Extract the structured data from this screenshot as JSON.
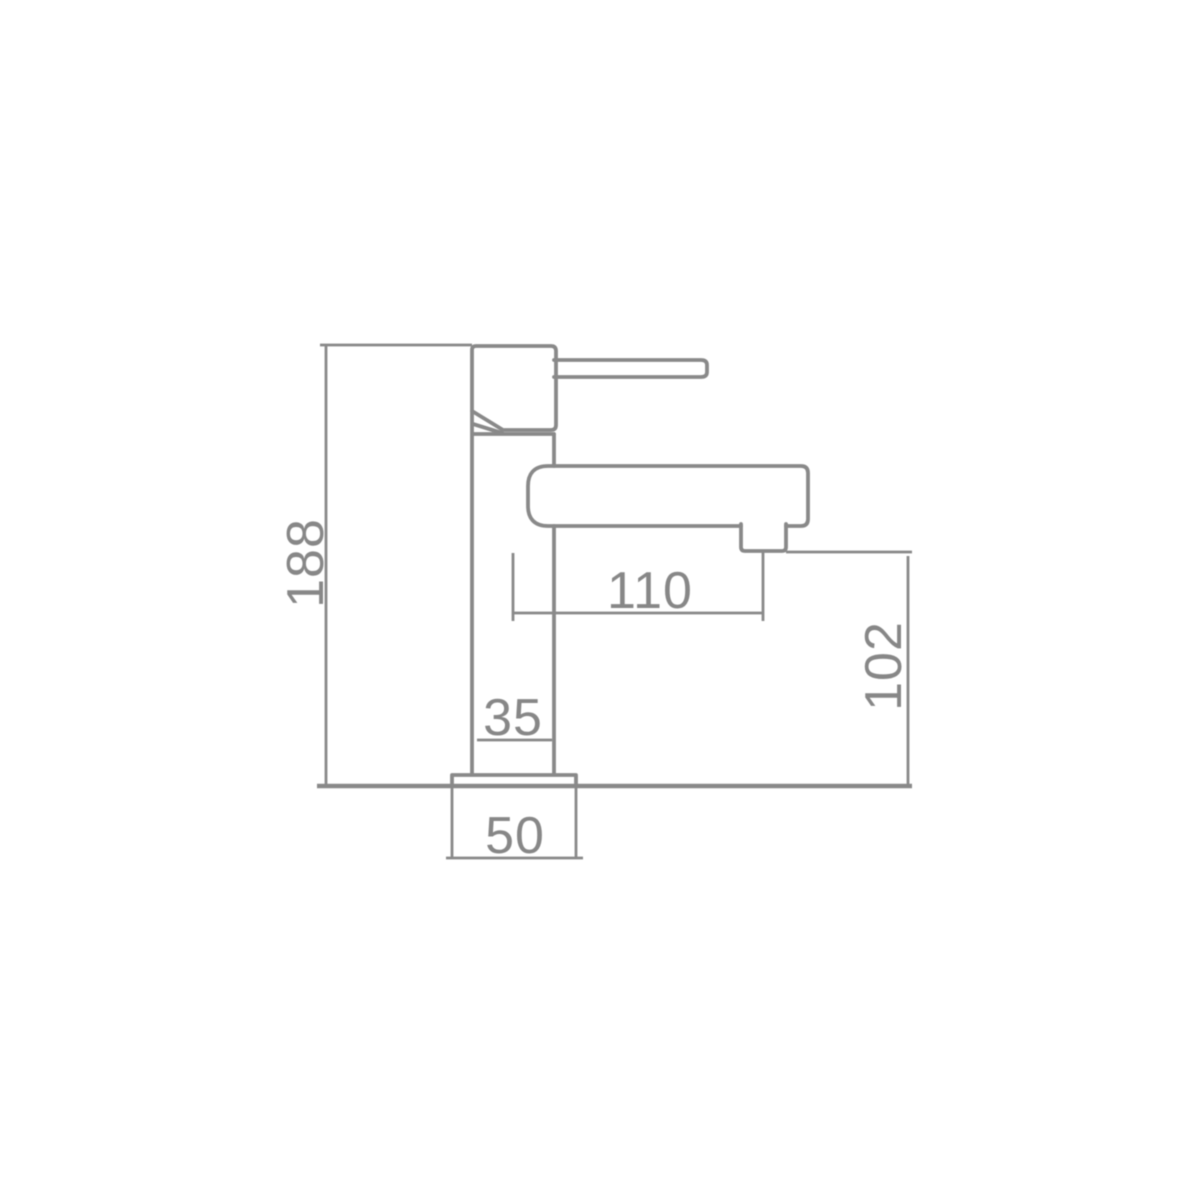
{
  "page": {
    "background_color": "#ffffff"
  },
  "drawing": {
    "kind": "technical-dimension-diagram",
    "subject": "basin mixer tap side elevation",
    "line_color": "#898989",
    "text_color": "#878787",
    "labels": {
      "overall_height": "188",
      "spout_reach": "110",
      "outlet_height": "102",
      "body_width": "35",
      "base_width": "50"
    }
  }
}
